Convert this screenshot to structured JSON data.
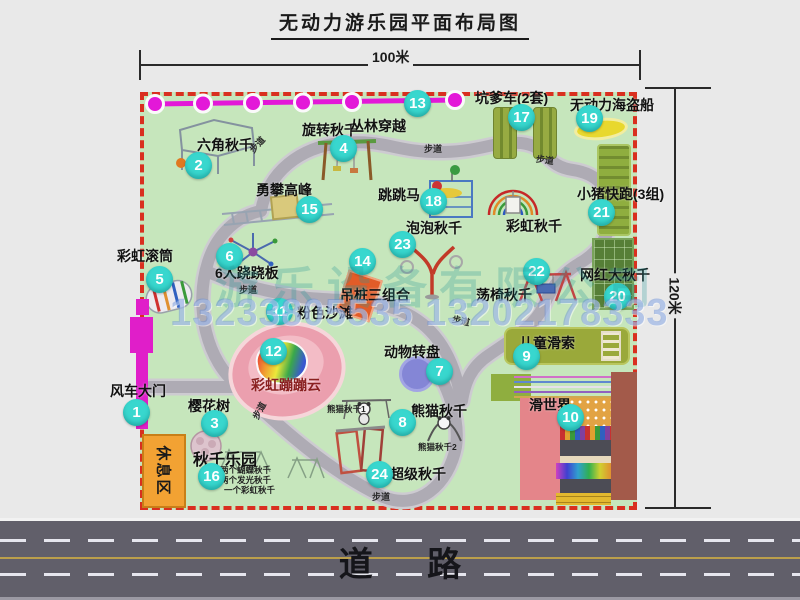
{
  "title": "无动力游乐园平面布局图",
  "dimensions": {
    "top": "100米",
    "right": "120米"
  },
  "road": {
    "label": "道路"
  },
  "labels": {
    "walkway": "步道",
    "rest_area": "休息区",
    "rainbow_swing": "彩虹秋千",
    "panda_sub1": "熊猫秋千1",
    "panda_sub2": "熊猫秋千2"
  },
  "swing_park_notes": [
    "两个蝴蝶秋千",
    "两个发光秋千",
    "一个彩虹秋千"
  ],
  "watermark": {
    "company": "游乐设备有限公司",
    "phone": "13233805535 13202178333"
  },
  "attractions": [
    {
      "num": "1",
      "label": "风车大门"
    },
    {
      "num": "2",
      "label": "六角秋千"
    },
    {
      "num": "3",
      "label": "樱花树"
    },
    {
      "num": "4",
      "label": "旋转秋千"
    },
    {
      "num": "5",
      "label": "彩虹滚筒"
    },
    {
      "num": "6",
      "label": "6人跷跷板"
    },
    {
      "num": "7",
      "label": "动物转盘"
    },
    {
      "num": "8",
      "label": "熊猫秋千"
    },
    {
      "num": "9",
      "label": "儿童滑索"
    },
    {
      "num": "10",
      "label": "滑世界"
    },
    {
      "num": "11",
      "label": "粉色沙滩"
    },
    {
      "num": "12",
      "label": "彩虹蹦蹦云"
    },
    {
      "num": "13",
      "label": "丛林穿越"
    },
    {
      "num": "14",
      "label": "吊桩三组合"
    },
    {
      "num": "15",
      "label": "勇攀高峰"
    },
    {
      "num": "16",
      "label": "秋千乐园"
    },
    {
      "num": "17",
      "label": "坑爹车(2套)"
    },
    {
      "num": "18",
      "label": "跳跳马"
    },
    {
      "num": "19",
      "label": "无动力海盗船"
    },
    {
      "num": "20",
      "label": "网红大秋千"
    },
    {
      "num": "21",
      "label": "小猪快跑(3组)"
    },
    {
      "num": "22",
      "label": "荡椅秋千"
    },
    {
      "num": "23",
      "label": "泡泡秋千"
    },
    {
      "num": "24",
      "label": "超级秋千"
    }
  ],
  "colors": {
    "park_green": "#c6e6bc",
    "border_red": "#d92f1f",
    "badge_teal": "#38d7ce",
    "gate_magenta": "#e01ec9",
    "zipline_magenta": "#e318d8",
    "road_gray": "#615f6a"
  }
}
